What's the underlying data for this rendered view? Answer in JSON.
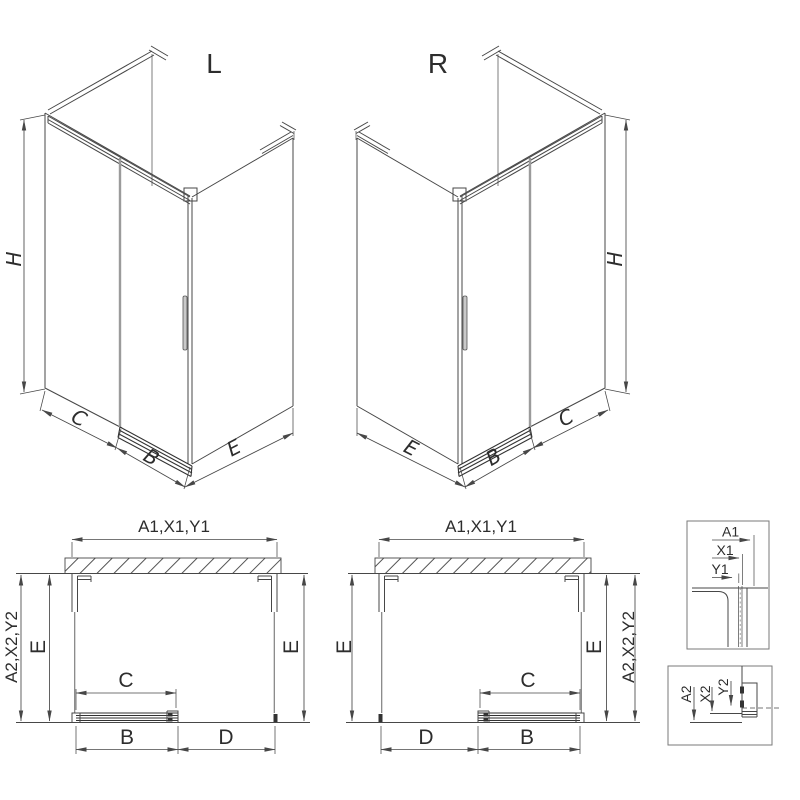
{
  "colors": {
    "line": "#474747",
    "rail": "#333333",
    "glass_edge": "#9b9b9b",
    "glass": "#7f7f7f",
    "box": "#7a7a7a",
    "hatch": "#555555",
    "text": "#2d2d2d",
    "bg": "#ffffff"
  },
  "iso_views": {
    "left": {
      "title": "L",
      "height": "H",
      "panel_width": "C",
      "door_width": "B",
      "side_depth": "E"
    },
    "right": {
      "title": "R",
      "height": "H",
      "panel_width": "C",
      "door_width": "B",
      "side_depth": "E"
    }
  },
  "plan_views": {
    "left": {
      "overall_width": "A1,X1,Y1",
      "overall_depth": "A2,X2,Y2",
      "depth_left": "E",
      "depth_right": "E",
      "door_opening": "C",
      "door_panel": "B",
      "fixed_panel": "D"
    },
    "right": {
      "overall_width": "A1,X1,Y1",
      "overall_depth": "A2,X2,Y2",
      "depth_left": "E",
      "depth_right": "E",
      "door_opening": "C",
      "door_panel": "B",
      "fixed_panel": "D"
    }
  },
  "details": {
    "wall_profile": {
      "dim_a": "A1",
      "dim_x": "X1",
      "dim_y": "Y1"
    },
    "bottom_profile": {
      "dim_a": "A2",
      "dim_x": "X2",
      "dim_y": "Y2"
    }
  }
}
